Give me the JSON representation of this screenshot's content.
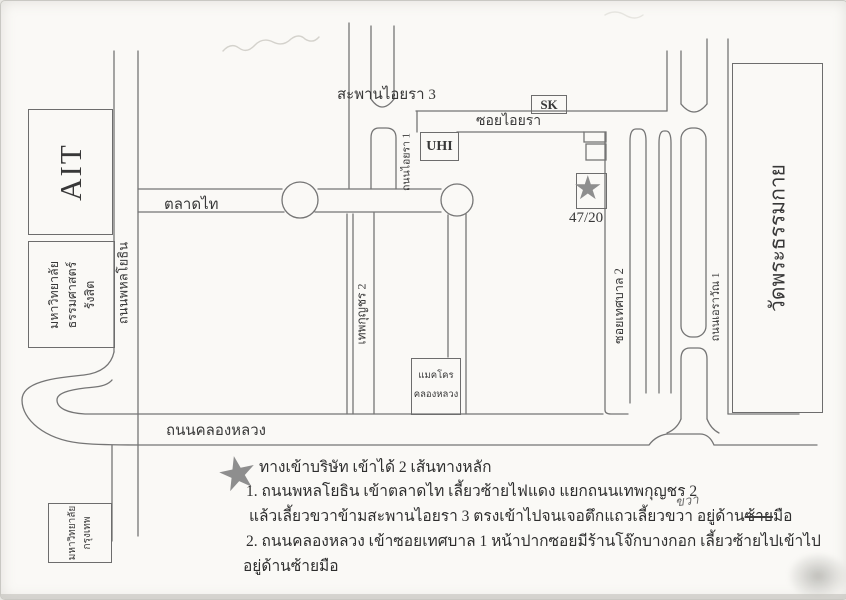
{
  "landmarks": {
    "ait": {
      "label": "AIT"
    },
    "thammasat": {
      "lines": [
        "มหาวิทยาลัย",
        "ธรรมศาสตร์",
        "รังสิต"
      ]
    },
    "bangkok_university": {
      "lines": [
        "มหาวิทยาลัย",
        "กรุงเทพ"
      ]
    },
    "wat": {
      "label": "วัดพระธรรมกาย"
    },
    "makro": {
      "lines": [
        "แมคโคร",
        "คลองหลวง"
      ]
    },
    "uhi": {
      "label": "UHI"
    },
    "sk": {
      "label": "SK"
    },
    "company": {
      "house_number": "47/20",
      "marker": "★"
    }
  },
  "roads": {
    "phahonyothin": "ถนนพหลโยธิน",
    "talad_thai": "ตลาดไท",
    "saphan_aiyara3": "สะพานไอยรา 3",
    "thanon_aiyara1": "ถนนไอยรา 1",
    "soi_aiyara": "ซอยไอยรา",
    "thepkunchorn2": "เทพกุญชร 2",
    "soi_thesaban2": "ซอยเทศบาล 2",
    "thanon_erawan1": "ถนนเอราวัณ 1",
    "khlong_luang": "ถนนคลองหลวง"
  },
  "legend": {
    "bullet": "★",
    "title": "ทางเข้าบริษัท เข้าได้ 2 เส้นทางหลัก",
    "step1": "1. ถนนพหลโยธิน เข้าตลาดไท เลี้ยวซ้ายไฟแดง แยกถนนเทพกุญชร 2",
    "step1_cont_prefix": "แล้วเลี้ยวขวาข้ามสะพานไอยรา 3 ตรงเข้าไปจนเจอตึกแถวเลี้ยวขวา อยู่ด้าน",
    "step1_struck_word": "ซ้าย",
    "step1_cont_suffix": "มือ",
    "handwritten_correction": "ขวา",
    "step2": "2. ถนนคลองหลวง เข้าซอยเทศบาล 1 หน้าปากซอยมีร้านโจ๊กบางกอก เลี้ยวซ้ายไปเข้าไป",
    "step2_cont": "อยู่ด้านซ้ายมือ"
  },
  "colors": {
    "ink": "#757575",
    "star_gray": "#8e8e8e",
    "paper": "#faf9f6"
  }
}
